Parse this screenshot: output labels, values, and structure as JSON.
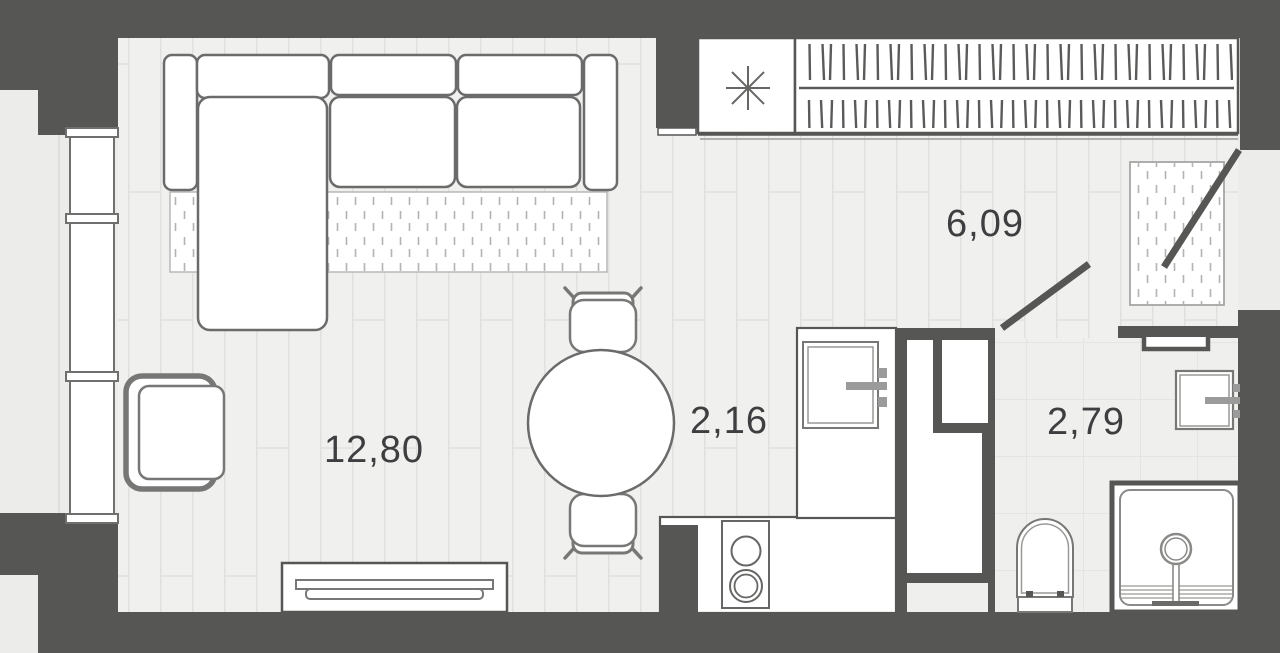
{
  "plan": {
    "type": "apartment-floor-plan",
    "rooms": [
      {
        "id": "living-room",
        "area_label": "12,80"
      },
      {
        "id": "kitchen",
        "area_label": "2,16"
      },
      {
        "id": "hallway",
        "area_label": "6,09"
      },
      {
        "id": "bathroom",
        "area_label": "2,79"
      }
    ],
    "symbols": {
      "utility_unit": "asterisk-8-point",
      "wardrobe": "hanger-rail",
      "doors_shown_open": 2
    },
    "colors": {
      "wall": "#565654",
      "floor": "#f0f0ee",
      "tile_floor": "#efefed",
      "outline": "#6b6b6b",
      "label": "#3e3e40",
      "faucet": "#9b9b9b",
      "background": "#ececea"
    }
  }
}
